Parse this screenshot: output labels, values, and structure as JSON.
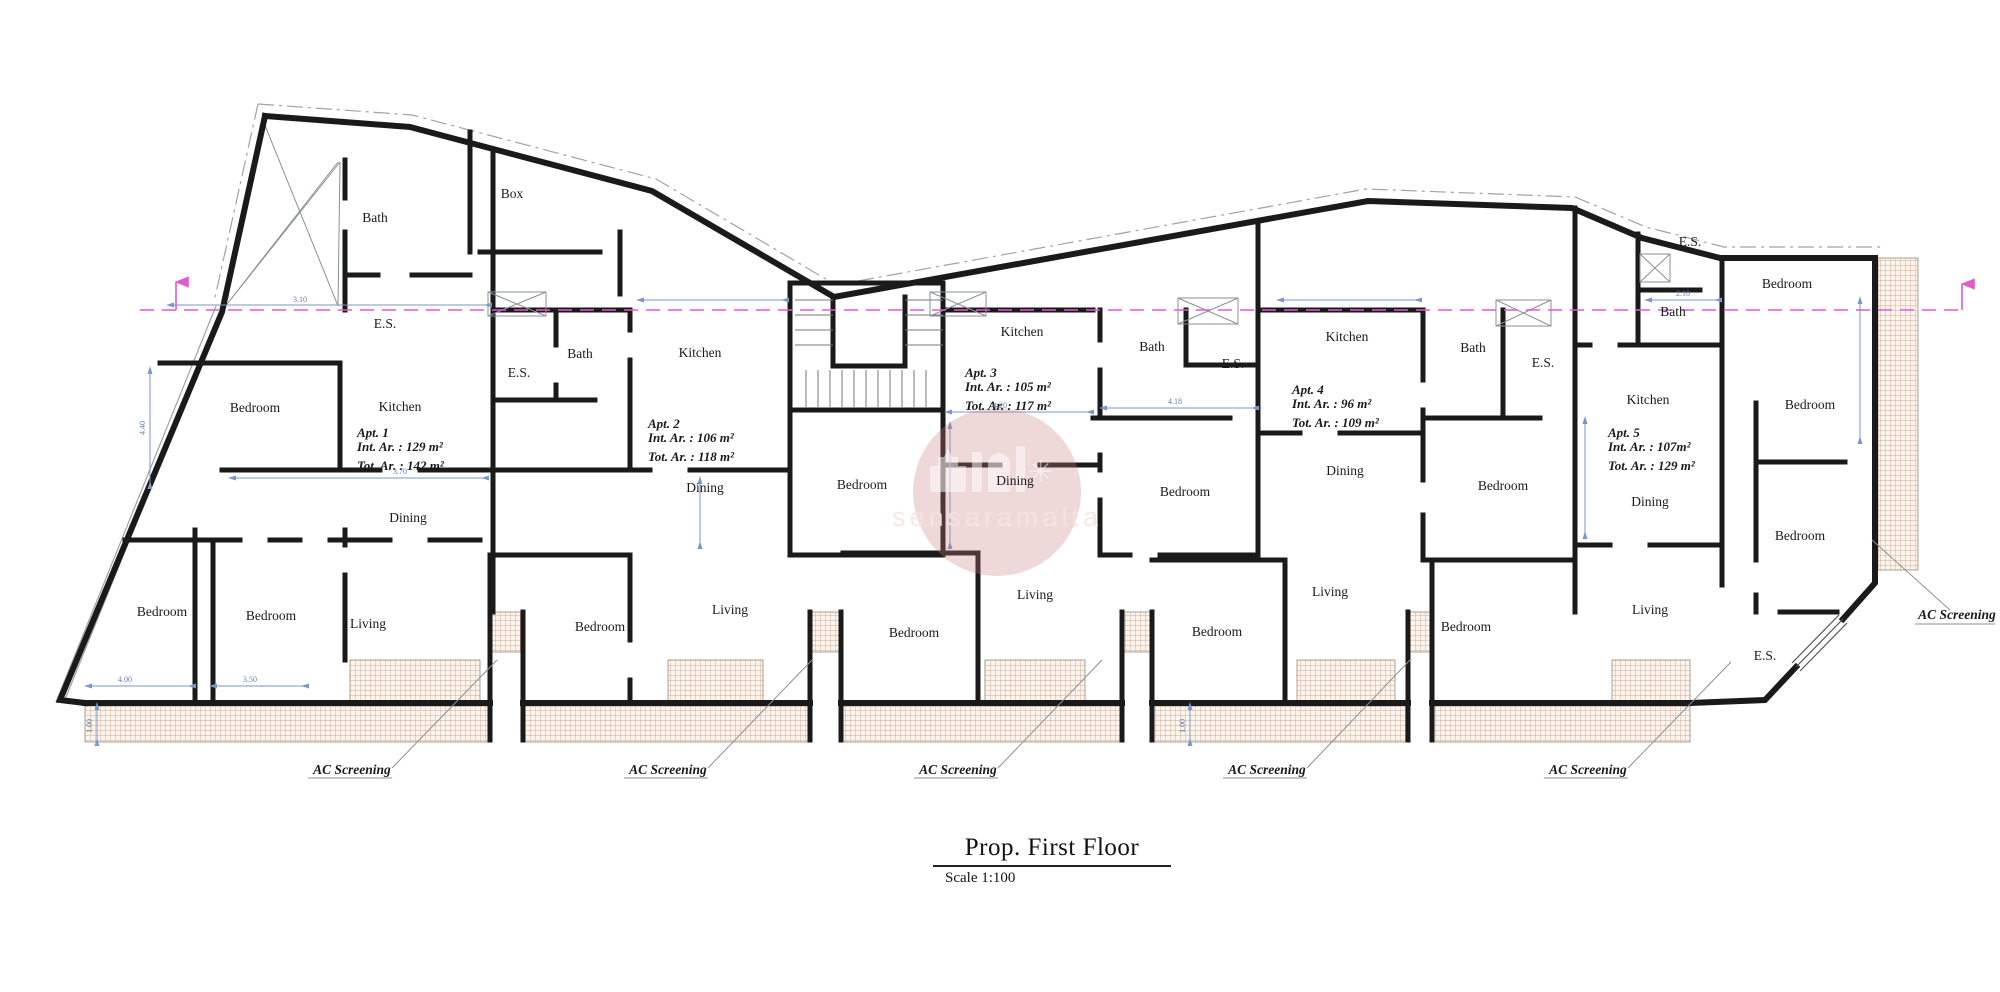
{
  "title_block": {
    "title": "Prop. First Floor",
    "scale": "Scale 1:100"
  },
  "watermark": {
    "text": "sensaramalta"
  },
  "colors": {
    "wall": "#1a1a1a",
    "dimension": "#7b96c8",
    "section_line": "#e05ad0",
    "hatch_line": "#d2a98f",
    "watermark_circle": "#c97f7f"
  },
  "plan": {
    "room_labels": [
      {
        "text": "Bath",
        "x": 375,
        "y": 222
      },
      {
        "text": "Box",
        "x": 512,
        "y": 198
      },
      {
        "text": "E.S.",
        "x": 385,
        "y": 328
      },
      {
        "text": "Bedroom",
        "x": 255,
        "y": 412
      },
      {
        "text": "Kitchen",
        "x": 400,
        "y": 411
      },
      {
        "text": "Dining",
        "x": 408,
        "y": 522
      },
      {
        "text": "Living",
        "x": 368,
        "y": 628
      },
      {
        "text": "Bedroom",
        "x": 162,
        "y": 616
      },
      {
        "text": "Bedroom",
        "x": 271,
        "y": 620
      },
      {
        "text": "E.S.",
        "x": 519,
        "y": 377
      },
      {
        "text": "Bath",
        "x": 580,
        "y": 358
      },
      {
        "text": "Kitchen",
        "x": 700,
        "y": 357
      },
      {
        "text": "Bedroom",
        "x": 862,
        "y": 489
      },
      {
        "text": "Dining",
        "x": 705,
        "y": 492
      },
      {
        "text": "Bedroom",
        "x": 600,
        "y": 631
      },
      {
        "text": "Living",
        "x": 730,
        "y": 614
      },
      {
        "text": "Bedroom",
        "x": 914,
        "y": 637
      },
      {
        "text": "Kitchen",
        "x": 1022,
        "y": 336
      },
      {
        "text": "Bath",
        "x": 1152,
        "y": 351
      },
      {
        "text": "E.S.",
        "x": 1233,
        "y": 368
      },
      {
        "text": "Dining",
        "x": 1015,
        "y": 485
      },
      {
        "text": "Bedroom",
        "x": 1185,
        "y": 496
      },
      {
        "text": "Living",
        "x": 1035,
        "y": 599
      },
      {
        "text": "Bedroom",
        "x": 1217,
        "y": 636
      },
      {
        "text": "Kitchen",
        "x": 1347,
        "y": 341
      },
      {
        "text": "Bath",
        "x": 1473,
        "y": 352
      },
      {
        "text": "E.S.",
        "x": 1543,
        "y": 367
      },
      {
        "text": "Dining",
        "x": 1345,
        "y": 475
      },
      {
        "text": "Bedroom",
        "x": 1503,
        "y": 490
      },
      {
        "text": "Living",
        "x": 1330,
        "y": 596
      },
      {
        "text": "Bedroom",
        "x": 1466,
        "y": 631
      },
      {
        "text": "E.S.",
        "x": 1690,
        "y": 246
      },
      {
        "text": "Bedroom",
        "x": 1787,
        "y": 288
      },
      {
        "text": "Bath",
        "x": 1673,
        "y": 316
      },
      {
        "text": "Kitchen",
        "x": 1648,
        "y": 404
      },
      {
        "text": "Bedroom",
        "x": 1810,
        "y": 409
      },
      {
        "text": "Dining",
        "x": 1650,
        "y": 506
      },
      {
        "text": "Bedroom",
        "x": 1800,
        "y": 540
      },
      {
        "text": "Living",
        "x": 1650,
        "y": 614
      },
      {
        "text": "E.S.",
        "x": 1765,
        "y": 660
      }
    ],
    "apartments": [
      {
        "name": "Apt. 1",
        "int_area": "Int. Ar. : 129 m²",
        "tot_area": "Tot. Ar. : 142 m²",
        "x": 357,
        "y": 437
      },
      {
        "name": "Apt. 2",
        "int_area": "Int. Ar. : 106 m²",
        "tot_area": "Tot. Ar. : 118 m²",
        "x": 648,
        "y": 428
      },
      {
        "name": "Apt. 3",
        "int_area": "Int. Ar. : 105 m²",
        "tot_area": "Tot. Ar. : 117 m²",
        "x": 965,
        "y": 377
      },
      {
        "name": "Apt. 4",
        "int_area": "Int. Ar. : 96 m²",
        "tot_area": "Tot. Ar. : 109 m²",
        "x": 1292,
        "y": 394
      },
      {
        "name": "Apt. 5",
        "int_area": "Int. Ar. : 107m²",
        "tot_area": "Tot. Ar. : 129 m²",
        "x": 1608,
        "y": 437
      }
    ],
    "ac_screening_labels": [
      {
        "text": "AC Screening",
        "x": 352,
        "y": 774
      },
      {
        "text": "AC Screening",
        "x": 668,
        "y": 774
      },
      {
        "text": "AC Screening",
        "x": 958,
        "y": 774
      },
      {
        "text": "AC Screening",
        "x": 1267,
        "y": 774
      },
      {
        "text": "AC Screening",
        "x": 1588,
        "y": 774
      },
      {
        "text": "AC Screening",
        "x": 1957,
        "y": 619
      }
    ],
    "dimensions": [
      {
        "text": "3.10",
        "x": 300,
        "y": 302,
        "rotate": 0
      },
      {
        "text": "4.20",
        "x": 1000,
        "y": 408,
        "rotate": 0
      },
      {
        "text": "4.18",
        "x": 1175,
        "y": 404,
        "rotate": 0
      },
      {
        "text": "3.70",
        "x": 400,
        "y": 474,
        "rotate": 0
      },
      {
        "text": "4.00",
        "x": 125,
        "y": 682,
        "rotate": 0
      },
      {
        "text": "3.50",
        "x": 250,
        "y": 682,
        "rotate": 0
      },
      {
        "text": "2.10",
        "x": 1683,
        "y": 296,
        "rotate": 0
      },
      {
        "text": "4.40",
        "x": 145,
        "y": 428,
        "rotate": -90
      },
      {
        "text": "1.00",
        "x": 92,
        "y": 726,
        "rotate": -90
      },
      {
        "text": "1.00",
        "x": 1185,
        "y": 726,
        "rotate": -90
      }
    ]
  }
}
